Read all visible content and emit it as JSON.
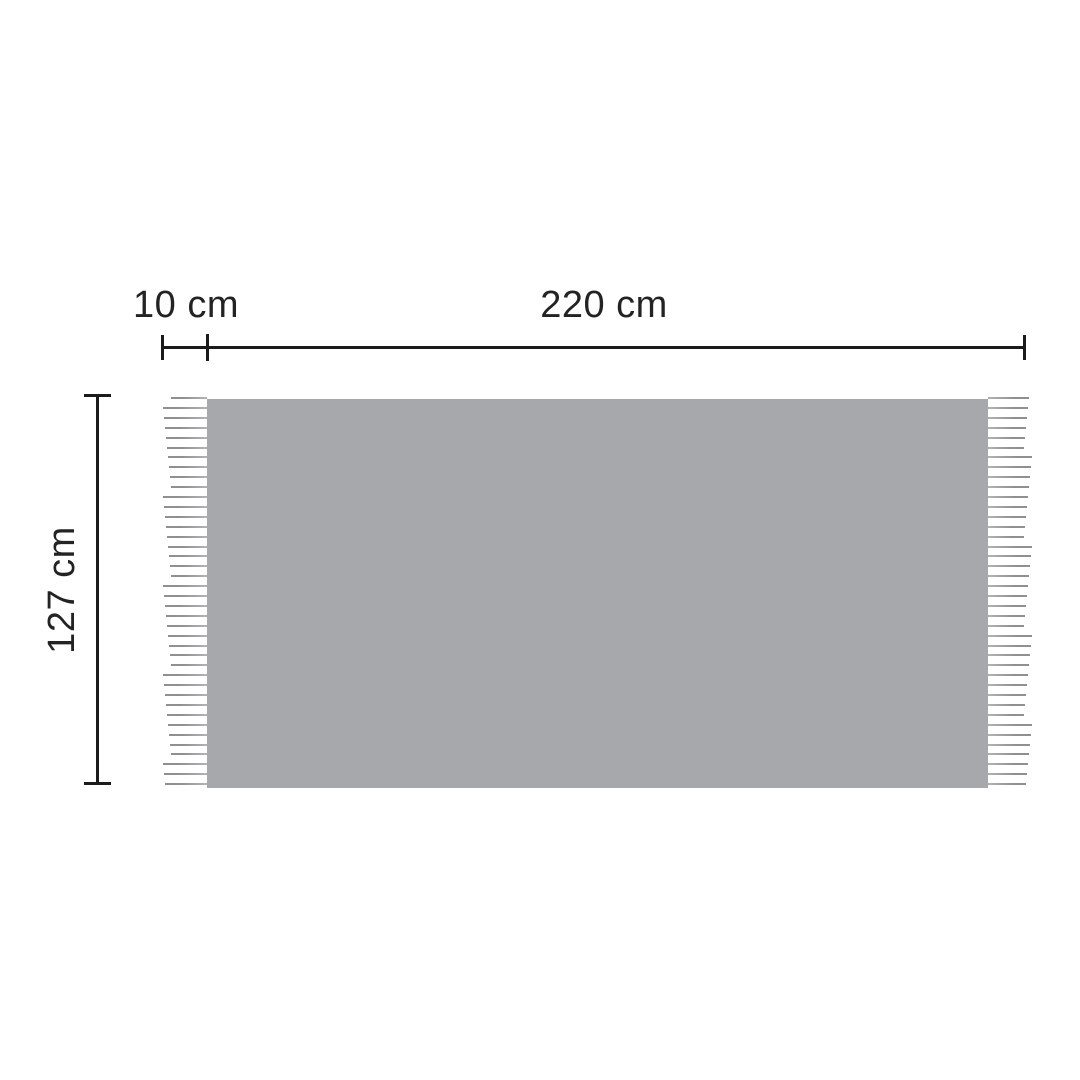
{
  "diagram": {
    "labels": {
      "fringe_width": "10 cm",
      "body_width": "220 cm",
      "height": "127 cm"
    },
    "colors": {
      "background": "#ffffff",
      "fabric": "#a6a8ab",
      "fringe_outer": "#8f9091",
      "fringe_inner": "#b2b3b5",
      "line": "#1b1b1b",
      "text": "#232323"
    },
    "fringe": {
      "count": 40,
      "spacing": 9.9,
      "max_length": 44,
      "min_length": 36,
      "thickness": 2
    }
  }
}
